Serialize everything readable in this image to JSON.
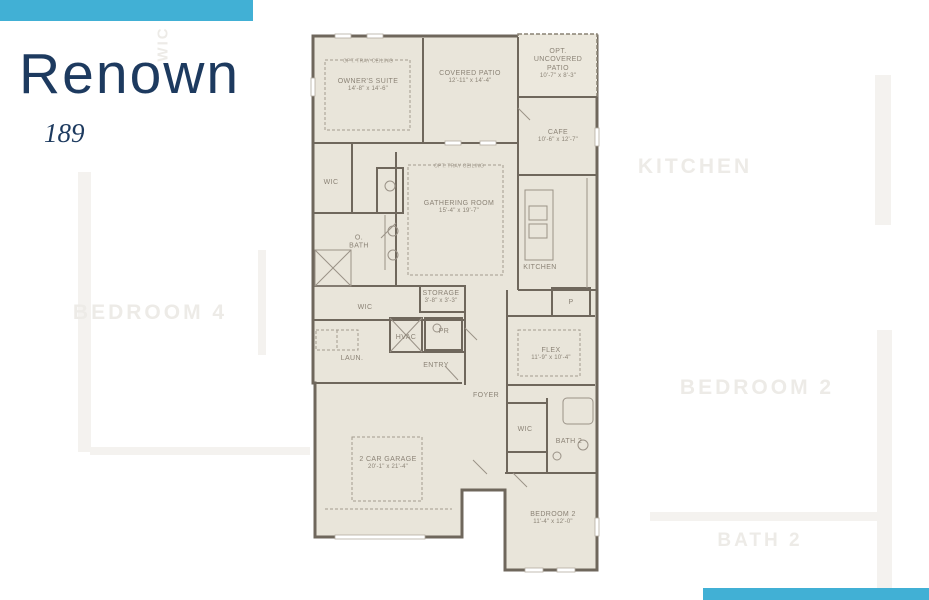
{
  "title": {
    "name": "Renown",
    "number": "189"
  },
  "accent": {
    "bar_color": "#41b0d5",
    "title_color": "#1d3a5f"
  },
  "plan": {
    "colors": {
      "wall": "#6f675c",
      "room_fill": "#e9e5da",
      "label_text": "#8b8376"
    },
    "annotations": {
      "tray_ceiling": "OPT. TRAY CEILING"
    },
    "rooms": {
      "owners_suite": {
        "name": "OWNER'S SUITE",
        "dims": "14'-8\" x 14'-6\""
      },
      "covered_patio": {
        "name": "COVERED PATIO",
        "dims": "12'-11\" x 14'-4\""
      },
      "opt_patio": {
        "name": "OPT. UNCOVERED PATIO",
        "dims": "10'-7\" x 8'-3\""
      },
      "cafe": {
        "name": "CAFE",
        "dims": "10'-6\" x 12'-7\""
      },
      "wic_owner": {
        "name": "WIC"
      },
      "o_bath": {
        "name": "O. BATH"
      },
      "gathering": {
        "name": "GATHERING ROOM",
        "dims": "15'-4\" x 19'-7\""
      },
      "kitchen": {
        "name": "KITCHEN"
      },
      "storage": {
        "name": "STORAGE",
        "dims": "3'-8\" x 3'-3\""
      },
      "wic_hall": {
        "name": "WIC"
      },
      "pantry": {
        "name": "P"
      },
      "pr": {
        "name": "PR"
      },
      "hvac": {
        "name": "HVAC"
      },
      "laundry": {
        "name": "LAUN."
      },
      "entry": {
        "name": "ENTRY"
      },
      "flex": {
        "name": "FLEX",
        "dims": "11'-9\" x 10'-4\""
      },
      "foyer": {
        "name": "FOYER"
      },
      "wic_bed2": {
        "name": "WIC"
      },
      "bath2": {
        "name": "BATH 2"
      },
      "garage": {
        "name": "2 CAR GARAGE",
        "dims": "20'-1\" x 21'-4\""
      },
      "bedroom2": {
        "name": "BEDROOM 2",
        "dims": "11'-4\" x 12'-0\""
      }
    }
  },
  "watermark": {
    "bedroom4": "BEDROOM 4",
    "kitchen": "KITCHEN",
    "bedroom2": "BEDROOM 2",
    "bath2": "BATH 2",
    "wic": "WIC"
  }
}
